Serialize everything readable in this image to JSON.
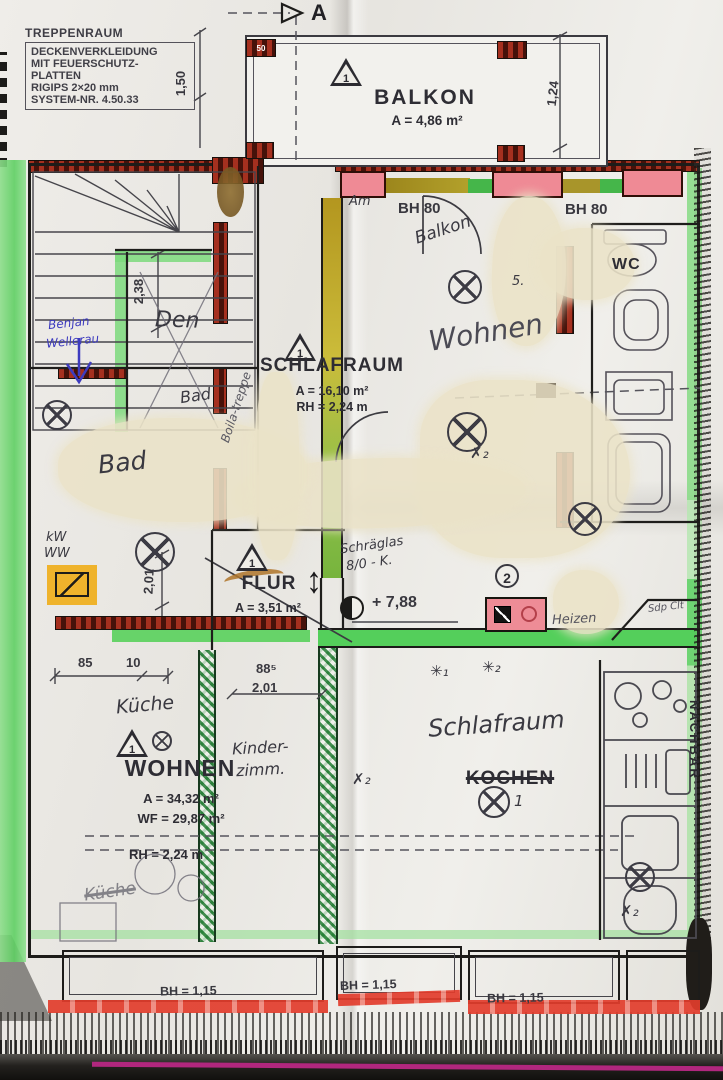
{
  "note": {
    "l1": "TREPPENRAUM",
    "l2": "DECKENVERKLEIDUNG",
    "l3": "MIT FEUERSCHUTZ-",
    "l4": "PLATTEN",
    "l5": "RIGIPS 2×20 mm",
    "l6": "SYSTEM-NR. 4.50.33"
  },
  "section": {
    "marker": "A"
  },
  "rooms": {
    "balkon": {
      "label": "BALKON",
      "area": "A = 4,86 m²"
    },
    "schlafraum": {
      "label": "SCHLAFRAUM",
      "area": "A = 16,10 m²",
      "rh": "RH = 2,24 m"
    },
    "flur": {
      "label": "FLUR",
      "area": "A = 3,51 m²"
    },
    "wohnen": {
      "label": "WOHNEN",
      "area": "A = 34,32 m²",
      "wf": "WF = 29,87 m²",
      "rh": "RH = 2,24 m"
    },
    "kochen": {
      "label": "KOCHEN"
    },
    "wc": {
      "label": "WC"
    }
  },
  "dims": {
    "v150": "1,50",
    "v124": "1,24",
    "v238": "2,38",
    "h85": "85",
    "h10": "10",
    "h885": "88⁵",
    "h201": "2,01",
    "v201": "2,01",
    "bh80": "BH 80",
    "bh115": "BH = 1,15",
    "level": "+ 7,88"
  },
  "symbols": {
    "tri": "1",
    "circ2": "2",
    "one": "1",
    "five": "5.",
    "corner": "50"
  },
  "hand": {
    "am": "Am",
    "balkon": "Balkon",
    "wohnen": "Wohnen",
    "badSmall": "Bad",
    "badBig": "Bad",
    "den": "Den",
    "kw": "kW",
    "ww": "WW",
    "kueche": "Küche",
    "kinder1": "Kinder-",
    "kinder2": "zimm.",
    "schlafraum": "Schlafraum",
    "heizen": "Heizen",
    "schraeg1": "Schräglas",
    "schraeg2": "8/0 - K.",
    "benjan": "Benjan",
    "wellerau": "Wellerau",
    "boila": "Boila-treppe",
    "sdp": "Sdp Clt",
    "kuecheBottom": "Küche",
    "nachbar": "NACHBAR",
    "x2a": "✗₂",
    "x2b": "✗₂",
    "x2c": "✗₂",
    "ast1": "✳₁",
    "ast2": "✳₂"
  }
}
